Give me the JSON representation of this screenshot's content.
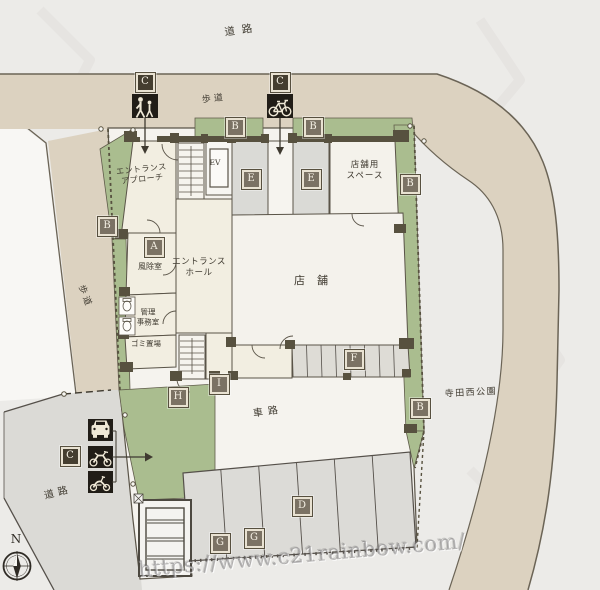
{
  "plan": {
    "title": "building site plan",
    "watermark": "https://www.c21rainbow.com/",
    "compass_label": "N",
    "colors": {
      "background": "#ecebe8",
      "sidewalk_beige": "#dcd2c0",
      "road_gray": "#dbdad6",
      "road_white": "#f8f7f4",
      "site_green": "#aabd8f",
      "building_cream": "#f2eee1",
      "room_gray": "#dadad6",
      "wall_brown": "#57513f",
      "marker_brown": "#7b7264",
      "marker_dark_brown": "#453e30",
      "icon_box_black": "#211d17"
    },
    "labels": [
      {
        "name": "road-top",
        "text": "道路",
        "x": 242,
        "y": 31,
        "rot": -8,
        "fs": 10.5,
        "ls": 7
      },
      {
        "name": "sidewalk-top",
        "text": "歩道",
        "x": 214,
        "y": 100,
        "rot": -6,
        "fs": 9,
        "ls": 3
      },
      {
        "name": "sidewalk-left",
        "text": "歩道",
        "x": 84,
        "y": 297,
        "rot": 70,
        "fs": 9,
        "ls": 3
      },
      {
        "name": "entrance-approach",
        "text": "エントランス\nアプローチ",
        "x": 142,
        "y": 175,
        "rot": -6,
        "fs": 8,
        "ls": 0.5
      },
      {
        "name": "elevator",
        "text": "EV",
        "x": 215,
        "y": 163,
        "rot": 0,
        "fs": 7.5,
        "ls": 0
      },
      {
        "name": "store-space",
        "text": "店舗用\nスペース",
        "x": 365,
        "y": 171,
        "rot": 0,
        "fs": 8.5,
        "ls": 1
      },
      {
        "name": "windbreak-room",
        "text": "風除室",
        "x": 150,
        "y": 267,
        "rot": 0,
        "fs": 8,
        "ls": 0
      },
      {
        "name": "entrance-hall",
        "text": "エントランス\nホール",
        "x": 199,
        "y": 268,
        "rot": 0,
        "fs": 8.5,
        "ls": 0.5
      },
      {
        "name": "store",
        "text": "店舗",
        "x": 317,
        "y": 281,
        "rot": 0,
        "fs": 11,
        "ls": 12
      },
      {
        "name": "management-office",
        "text": "管理\n事務室",
        "x": 148,
        "y": 317,
        "rot": 0,
        "fs": 7.5,
        "ls": 0
      },
      {
        "name": "garbage-area",
        "text": "ゴミ置場",
        "x": 146,
        "y": 344,
        "rot": 0,
        "fs": 7.5,
        "ls": 0
      },
      {
        "name": "driveway",
        "text": "車路",
        "x": 268,
        "y": 412,
        "rot": -8,
        "fs": 10,
        "ls": 5
      },
      {
        "name": "park",
        "text": "寺田西公園",
        "x": 471,
        "y": 394,
        "rot": -3,
        "fs": 9,
        "ls": 1.5
      },
      {
        "name": "road-bottom",
        "text": "道路",
        "x": 58,
        "y": 493,
        "rot": -14,
        "fs": 10,
        "ls": 4
      }
    ],
    "markers": [
      {
        "letter": "C",
        "x": 145,
        "y": 82,
        "variant": "dark"
      },
      {
        "letter": "C",
        "x": 280,
        "y": 82,
        "variant": "dark"
      },
      {
        "letter": "C",
        "x": 70,
        "y": 456,
        "variant": "dark"
      },
      {
        "letter": "B",
        "x": 235,
        "y": 127
      },
      {
        "letter": "B",
        "x": 313,
        "y": 127
      },
      {
        "letter": "B",
        "x": 410,
        "y": 184
      },
      {
        "letter": "B",
        "x": 107,
        "y": 226
      },
      {
        "letter": "B",
        "x": 420,
        "y": 408
      },
      {
        "letter": "A",
        "x": 154,
        "y": 247
      },
      {
        "letter": "E",
        "x": 251,
        "y": 179
      },
      {
        "letter": "E",
        "x": 311,
        "y": 179
      },
      {
        "letter": "F",
        "x": 354,
        "y": 359
      },
      {
        "letter": "H",
        "x": 178,
        "y": 397
      },
      {
        "letter": "I",
        "x": 219,
        "y": 384
      },
      {
        "letter": "D",
        "x": 302,
        "y": 506
      },
      {
        "letter": "G",
        "x": 220,
        "y": 543
      },
      {
        "letter": "G",
        "x": 254,
        "y": 538
      }
    ],
    "icons": [
      "pedestrian-icon",
      "bicycle-icon",
      "car-icon",
      "motorcycle-icon",
      "scooter-icon",
      "compass-icon"
    ]
  }
}
